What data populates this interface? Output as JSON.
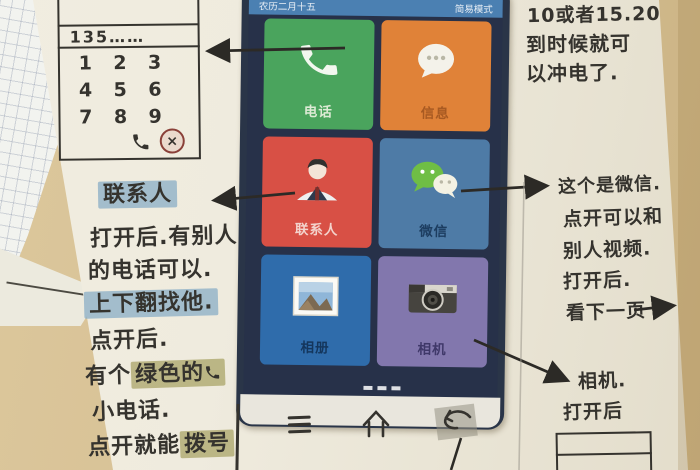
{
  "sketch": {
    "dialer": {
      "number": "135……",
      "keys": [
        "1",
        "2",
        "3",
        "4",
        "5",
        "6",
        "7",
        "8",
        "9"
      ],
      "call_icon": "handset-icon",
      "delete_icon": "circled-x-icon"
    },
    "left_notes": {
      "contacts_chip": "联系人",
      "line1": "打开后.有别人",
      "line2": "的电话可以.",
      "line3": "上下翻找他.",
      "line4": "点开后.",
      "line5_pre": "有个",
      "line5_hl": "绿色的",
      "line6": "小电话.",
      "line7_pre": "点开就能",
      "line7_hl": "拨号"
    },
    "right_notes": {
      "charge1": "10或者15.20",
      "charge2": "到时候就可",
      "charge3": "以冲电了.",
      "wechat1": "这个是微信.",
      "wechat2": "点开可以和",
      "wechat3": "别人视频.",
      "wechat4": "打开后.",
      "wechat5": "看下一页",
      "camera1": "相机.",
      "camera2": "打开后"
    }
  },
  "phone": {
    "status_left": "农历二月十五",
    "status_right": "简易模式",
    "tiles": [
      {
        "label": "电话",
        "color": "#4aa45d",
        "icon": "phone-handset-icon"
      },
      {
        "label": "信息",
        "color": "#e08238",
        "icon": "message-bubble-icon"
      },
      {
        "label": "联系人",
        "color": "#d85045",
        "icon": "contact-person-icon"
      },
      {
        "label": "微信",
        "color": "#4e7ba6",
        "icon": "wechat-icon"
      },
      {
        "label": "相册",
        "color": "#2f6cab",
        "icon": "photo-album-icon"
      },
      {
        "label": "相机",
        "color": "#8277ad",
        "icon": "camera-icon"
      }
    ]
  },
  "nav": {
    "menu_icon": "menu-icon",
    "home_icon": "home-icon",
    "back_icon": "back-icon"
  },
  "colors": {
    "paper": "#efebde",
    "desk_tan": "#d5bf92",
    "ink": "#35332e",
    "highlight_blue": "#8aadc6",
    "highlight_olive": "#a5a05f",
    "screen_bg": "#273149",
    "statusbar_blue": "#4b80b2"
  }
}
